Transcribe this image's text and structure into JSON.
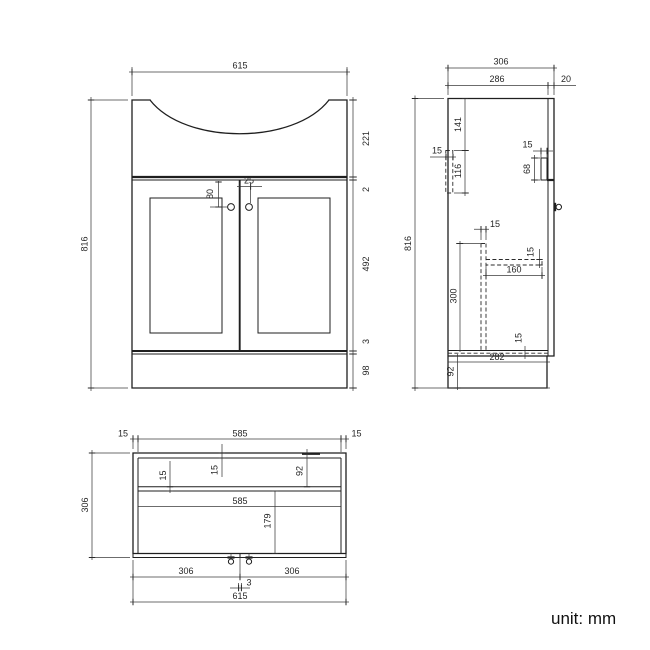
{
  "footer": {
    "units_label": "unit: mm"
  },
  "front_view": {
    "overall_width": "615",
    "overall_height": "816",
    "basin_height": "221",
    "top_gap": "2",
    "door_height": "492",
    "bottom_gap": "3",
    "plinth_height": "98",
    "knob_drop": "80",
    "knob_offset": "25"
  },
  "side_view": {
    "overall_depth": "306",
    "carcass_depth": "286",
    "door_thickness": "20",
    "overall_height": "816",
    "rail_top_offset": "141",
    "rail_height": "116",
    "rail_thickness": "15",
    "filler_thickness": "15",
    "filler_height": "68",
    "support_thickness": "15",
    "support_height": "300",
    "shelf_depth": "160",
    "shelf_thickness": "15",
    "bottom_panel_thickness": "15",
    "bottom_panel_depth": "282",
    "plinth_recess_height": "92"
  },
  "plan_view": {
    "side_panel_thickness_left": "15",
    "internal_width_top": "585",
    "side_panel_thickness_right": "15",
    "overall_depth": "306",
    "back_panel_thickness": "15",
    "rail_thickness": "15",
    "basin_back_depth": "92",
    "internal_width": "585",
    "basin_front_depth": "179",
    "door_width_left": "306",
    "door_width_right": "306",
    "door_gap": "3",
    "overall_width": "615"
  }
}
